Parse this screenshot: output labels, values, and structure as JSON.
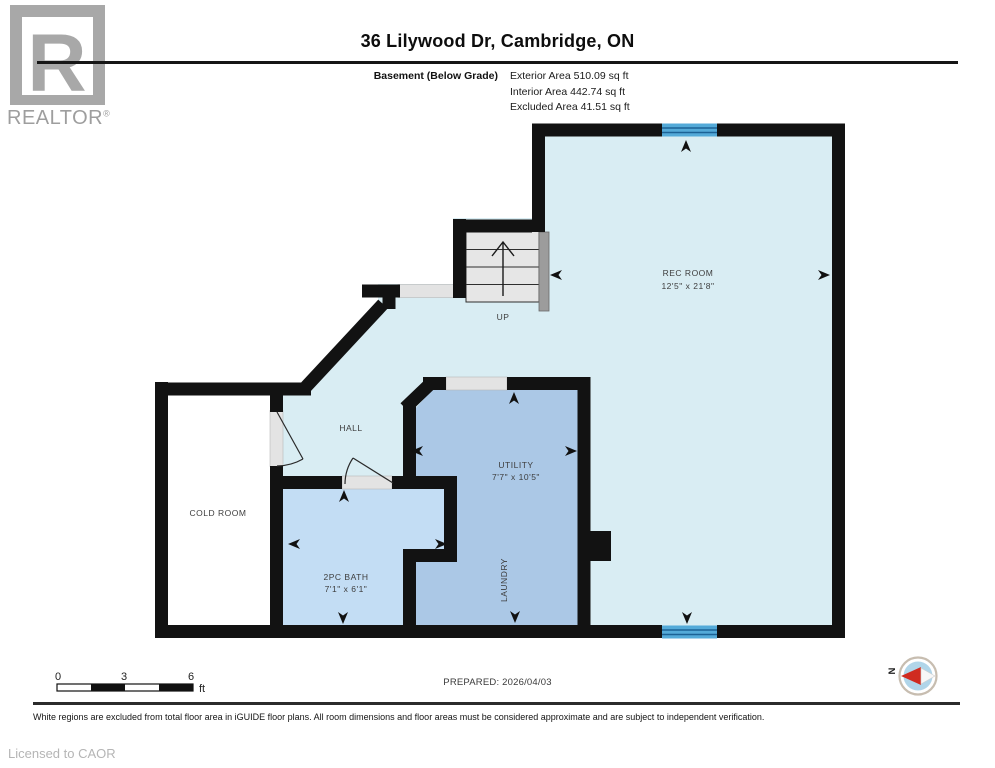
{
  "branding": {
    "logo_letter": "R",
    "logo_text": "REALTOR",
    "registered_mark": "®",
    "license": "Licensed to CAOR"
  },
  "header": {
    "title": "36 Lilywood Dr, Cambridge, ON",
    "floor_label": "Basement (Below Grade)",
    "areas": {
      "exterior": "Exterior Area 510.09 sq ft",
      "interior": "Interior Area 442.74 sq ft",
      "excluded": "Excluded Area 41.51 sq ft"
    }
  },
  "plan": {
    "rooms": {
      "rec_room": {
        "name": "REC ROOM",
        "dims": "12'5\" x 21'8\""
      },
      "utility": {
        "name": "UTILITY",
        "dims": "7'7\" x 10'5\""
      },
      "laundry": {
        "name": "LAUNDRY"
      },
      "bath": {
        "name": "2PC BATH",
        "dims": "7'1\" x 6'1\""
      },
      "cold_room": {
        "name": "COLD ROOM"
      },
      "hall": {
        "name": "HALL"
      },
      "stairs": {
        "direction": "UP"
      }
    },
    "compass": {
      "north_label": "N"
    }
  },
  "scale_bar": {
    "tick_0": "0",
    "tick_3": "3",
    "tick_6": "6",
    "unit": "ft"
  },
  "prepared_label": "PREPARED: 2026/04/03",
  "disclaimer": "White regions are excluded from total floor area in iGUIDE floor plans. All room dimensions and floor areas must be considered approximate and are subject to independent verification.",
  "colors": {
    "wall": "#121212",
    "rec_hall_fill": "#d9edf3",
    "utility_fill": "#abc8e6",
    "bath_fill": "#c3ddf4",
    "cold_fill": "#ffffff",
    "window": "#54aad8",
    "window_line": "#1c6295",
    "compass_red": "#d02b20",
    "logo_gray": "#a8a8a8"
  }
}
